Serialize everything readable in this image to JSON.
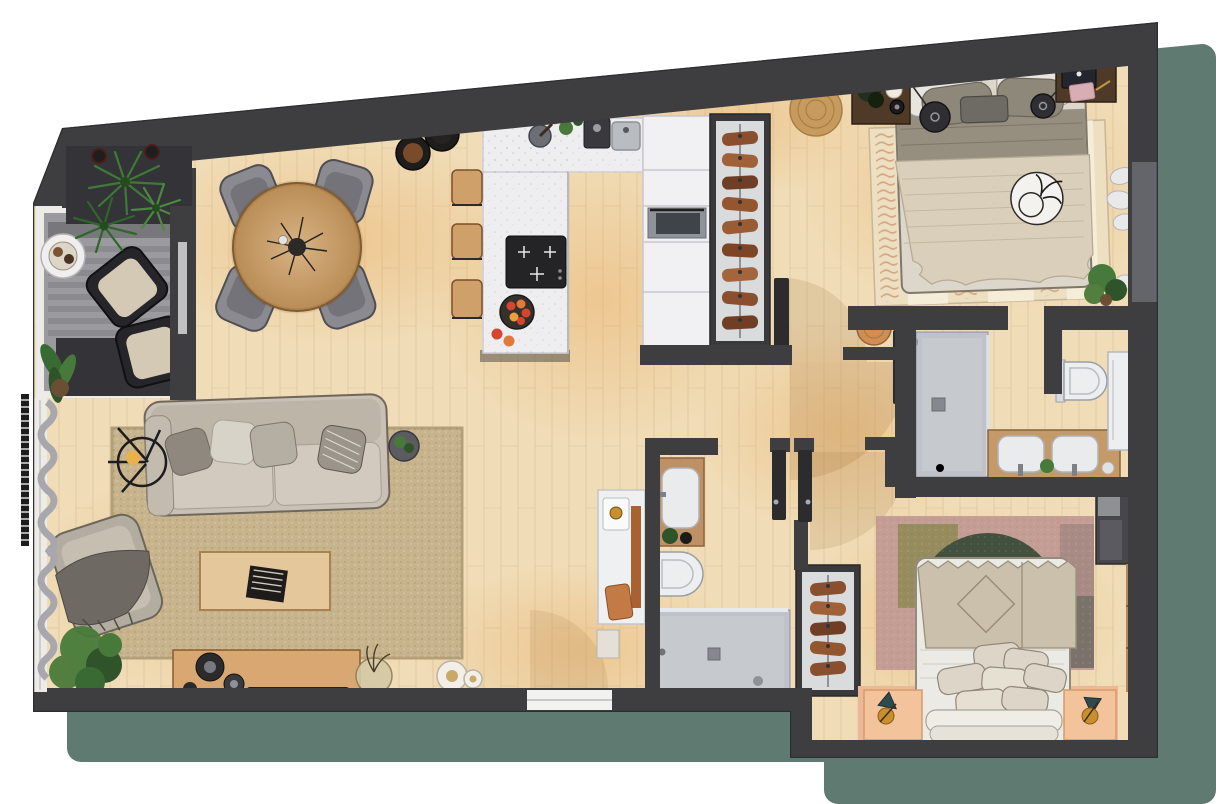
{
  "scene": {
    "name": "apartment-floor-plan-top-view",
    "width": 1219,
    "height": 804,
    "style": "photoreal 3d rendered floor plan, no text labels"
  },
  "palette": {
    "background": "#ffffff",
    "shadow": "#5f7a71",
    "wall": "#3e3e41",
    "wallFace": "#57575c",
    "recess": "#64646b",
    "planter": "#333338",
    "floorWood": "#f0ddb8",
    "balconyFloor": "#9b9b9f",
    "frameWhite": "#ecebe8",
    "curtain": "#a7a7ad",
    "rugLiving": "#c7b48c",
    "sofa": "#c9c1b5",
    "sofaCushion": "#d2cabe",
    "pillowGray": "#8e887f",
    "pillowLight": "#d8d3c9",
    "tableWood": "#c9a06b",
    "chair": "#8b8a90",
    "coffeeTable": "#e5c79c",
    "consoleWood": "#d9a771",
    "counter": "#eeeef1",
    "cooktop": "#242427",
    "cabinet": "#f1f1f3",
    "appliance": "#8e939a",
    "stoolWood": "#cfa06a",
    "closetInterior": "#dadbdd",
    "clothesCopper": "#9a5c34",
    "jute": "#c79b5e",
    "stoolOrange": "#d08e55",
    "bedSheet": "#ddd7cb",
    "blanketOlive": "#968e7e",
    "throwCream": "#d9cfba",
    "rugCream": "#ecdfc2",
    "nightstandWood": "#4f3a28",
    "pendantDark": "#2f2f33",
    "showerFloor": "#bfc2c8",
    "glass": "#dde3e8",
    "vanityWood": "#c49a68",
    "sinkWhite": "#e9ebed",
    "toiletWhite": "#eceeef",
    "cabinetWhite": "#eceef0",
    "doorLeaf": "#2c2c2f",
    "arcShade": "rgba(150,98,45,0.16)",
    "salmonPlatform": "#edb894",
    "nightstandSalmon": "#f3c49c",
    "rugBlush": "#c49d95",
    "rugGreenArc": "#42503e",
    "rugOlive": "#8f8a55",
    "rugGray": "#6f6b65",
    "duvet": "#eceae5",
    "throwDiamond": "#cbc0ab",
    "pillowStack": "#ddd6c8",
    "wardrobeDark": "#47474b",
    "windowGlass": "#a3b1bc",
    "windowFrame": "#b08a5c",
    "lampTeal": "#2e4a4e",
    "lampGold": "#c98f2e",
    "plantGreen": "#477a3a",
    "plantDark": "#2f5429",
    "mediaDark": "#26262a",
    "fruitRed": "#d6452f",
    "fruitOrange": "#e0793a",
    "plateWhite": "#f2efe8"
  },
  "inventory": {
    "balcony": [
      "lounge-chair",
      "lounge-chair",
      "round-side-table",
      "striped-rug",
      "palm-plants",
      "banana-plant",
      "planter-box"
    ],
    "living_room": [
      "sofa",
      "throw-pillows",
      "armchair",
      "throw-blanket",
      "coffee-table",
      "book",
      "jute-rug",
      "floor-lamp",
      "side-table-plant",
      "media-console",
      "speakers",
      "soundbar",
      "branch-vase",
      "decor-plates",
      "large-plant",
      "white-sideboard"
    ],
    "dining_area": [
      "round-dining-table",
      "dining-chair",
      "dining-chair",
      "dining-chair",
      "dining-chair",
      "twig-centerpiece"
    ],
    "kitchen": [
      "island-counter",
      "induction-cooktop",
      "fruit-bowl",
      "bar-stool",
      "bar-stool",
      "bar-stool",
      "sink",
      "coffee-machine",
      "mortar",
      "tall-cabinets",
      "oven",
      "round-trays"
    ],
    "entry": [
      "coat-closet",
      "hanging-clothes",
      "jute-mat",
      "entry-door",
      "round-stool"
    ],
    "bedroom_1": [
      "double-bed",
      "pillows",
      "olive-blanket",
      "cream-throw",
      "decor-plate",
      "nightstand",
      "nightstand",
      "laptop",
      "notepad",
      "pendant-lamp",
      "pendant-lamp",
      "striped-rug",
      "wall-hooks-clothes",
      "plant"
    ],
    "bathroom_1": [
      "walk-in-shower",
      "glass-screen",
      "double-vanity",
      "sink",
      "sink",
      "toilet",
      "partition-door",
      "tall-white-cabinet"
    ],
    "bathroom_2": [
      "vanity-sink",
      "toilet",
      "walk-in-shower",
      "glass-screen"
    ],
    "bedroom_2": [
      "double-bed",
      "pillow-stack",
      "diamond-throw",
      "abstract-rug",
      "nightstand",
      "nightstand",
      "table-lamp",
      "table-lamp",
      "wardrobe",
      "window",
      "open-closet",
      "hanging-clothes",
      "salmon-platform"
    ]
  }
}
